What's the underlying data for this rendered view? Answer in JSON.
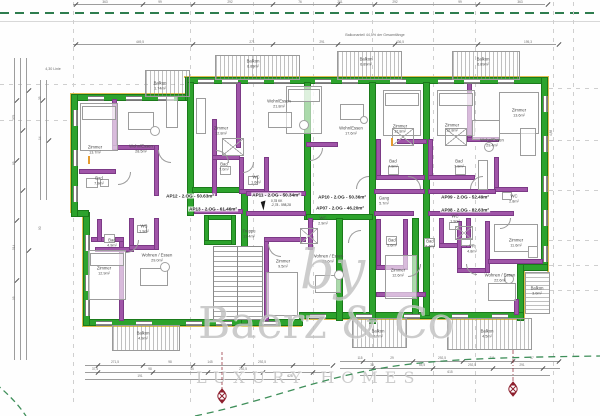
{
  "annotations": {
    "linie": "4,30 Linie",
    "balkon_note": "Balkonanteil 44,5% der Gesamtlänge",
    "right_dim": "4,88"
  },
  "watermark": {
    "by": "by",
    "brand": "Baerz & Co",
    "tagline": "LUXURY HOMES"
  },
  "cursor_tooltip": {
    "line1": "0,78 KK",
    "line2": "-2,78 - 598,28"
  },
  "apartments": [
    {
      "label": "AP12 - 2.OG - 50.63m²",
      "x": 190,
      "y": 196
    },
    {
      "label": "AP11 - 2.OG - 50.34m²",
      "x": 276,
      "y": 195
    },
    {
      "label": "AP10 - 2.OG - 50.36m²",
      "x": 342,
      "y": 197
    },
    {
      "label": "AP09 - 2.OG - 52.49m²",
      "x": 465,
      "y": 197
    },
    {
      "label": "AP13 - 2.OG - 61.46m²",
      "x": 213,
      "y": 209
    },
    {
      "label": "AP07 - 2.OG - 46.20m²",
      "x": 340,
      "y": 208
    },
    {
      "label": "AP08 - 2.OG - 82.63m²",
      "x": 465,
      "y": 210
    }
  ],
  "rooms": [
    {
      "name": "Zimmer",
      "area": "13.7m²",
      "x": 95,
      "y": 150
    },
    {
      "name": "Wohn/Essen",
      "area": "28.5m²",
      "x": 141,
      "y": 149
    },
    {
      "name": "Bad",
      "area": "7.9m²",
      "x": 99,
      "y": 181
    },
    {
      "name": "Balkon",
      "area": "1.74m²",
      "x": 160,
      "y": 86
    },
    {
      "name": "Balkon",
      "area": "6.89m²",
      "x": 253,
      "y": 64
    },
    {
      "name": "Balkon",
      "area": "6.89m²",
      "x": 366,
      "y": 62
    },
    {
      "name": "Balkon",
      "area": "6.89m²",
      "x": 483,
      "y": 62
    },
    {
      "name": "Zimmer",
      "area": "12.8m²",
      "x": 221,
      "y": 131
    },
    {
      "name": "Wohn/Essen",
      "area": "21.8m²",
      "x": 279,
      "y": 104
    },
    {
      "name": "Bad",
      "area": "7.0m²",
      "x": 224,
      "y": 167
    },
    {
      "name": "WC",
      "area": "1.6m²",
      "x": 256,
      "y": 180
    },
    {
      "name": "Wohn/Essen",
      "area": "17.6m²",
      "x": 351,
      "y": 131
    },
    {
      "name": "Zimmer",
      "area": "12.8m²",
      "x": 400,
      "y": 129
    },
    {
      "name": "Zimmer",
      "area": "12.8m²",
      "x": 452,
      "y": 128
    },
    {
      "name": "Wohn/Essen",
      "area": "29.4m²",
      "x": 492,
      "y": 143
    },
    {
      "name": "Bad",
      "area": "7.9m²",
      "x": 393,
      "y": 164
    },
    {
      "name": "Bad",
      "area": "7.9m²",
      "x": 459,
      "y": 164
    },
    {
      "name": "Gang",
      "area": "5.7m²",
      "x": 384,
      "y": 201
    },
    {
      "name": "WC",
      "area": "2.8m²",
      "x": 514,
      "y": 199
    },
    {
      "name": "Treppe",
      "area": "13.4m²",
      "x": 249,
      "y": 234
    },
    {
      "name": "Zimmer",
      "area": "12.9m²",
      "x": 104,
      "y": 271
    },
    {
      "name": "Bad",
      "area": "4.9m²",
      "x": 112,
      "y": 243
    },
    {
      "name": "WC",
      "area": "1.9m²",
      "x": 144,
      "y": 229
    },
    {
      "name": "Wohnen / Essen",
      "area": "29.0m²",
      "x": 157,
      "y": 258
    },
    {
      "name": "Balkon",
      "area": "4.9m²",
      "x": 143,
      "y": 336
    },
    {
      "name": "Zimmer",
      "area": "9.5m²",
      "x": 283,
      "y": 264
    },
    {
      "name": "Wohnen / Essen",
      "area": "23.6m²",
      "x": 328,
      "y": 259
    },
    {
      "name": "WC",
      "area": "2.9m²",
      "x": 323,
      "y": 221
    },
    {
      "name": "Bad",
      "area": "5.6m²",
      "x": 392,
      "y": 243
    },
    {
      "name": "Zimmer",
      "area": "12.6m²",
      "x": 398,
      "y": 273
    },
    {
      "name": "WC",
      "area": "1.9m²",
      "x": 455,
      "y": 219
    },
    {
      "name": "Bad",
      "area": "7.4m²",
      "x": 430,
      "y": 244
    },
    {
      "name": "VR",
      "area": "4.8m²",
      "x": 472,
      "y": 249
    },
    {
      "name": "Zimmer",
      "area": "11.6m²",
      "x": 516,
      "y": 243
    },
    {
      "name": "Wohnen / Essen",
      "area": "22.6m²",
      "x": 500,
      "y": 278
    },
    {
      "name": "Balkon",
      "area": "4.9m²",
      "x": 378,
      "y": 334
    },
    {
      "name": "Balkon",
      "area": "4.5m²",
      "x": 487,
      "y": 334
    },
    {
      "name": "Balkon",
      "area": "3.0m²",
      "x": 537,
      "y": 291
    },
    {
      "name": "Zimmer",
      "area": "13.6m²",
      "x": 519,
      "y": 113
    }
  ],
  "dims": {
    "top": [
      {
        "v": "363",
        "x": 105
      },
      {
        "v": "99",
        "x": 160
      },
      {
        "v": "292",
        "x": 230
      },
      {
        "v": "76",
        "x": 300
      },
      {
        "v": "201",
        "x": 340
      },
      {
        "v": "292",
        "x": 395
      },
      {
        "v": "99",
        "x": 460
      },
      {
        "v": "363",
        "x": 520
      }
    ],
    "mid": [
      {
        "v": "449,5",
        "x": 140
      },
      {
        "v": "271",
        "x": 252
      },
      {
        "v": "291",
        "x": 322
      },
      {
        "v": "436,5",
        "x": 400
      },
      {
        "v": "195,3",
        "x": 528
      }
    ],
    "left": [
      {
        "v": "375",
        "y": 120
      },
      {
        "v": "85",
        "y": 165
      },
      {
        "v": "514",
        "y": 250
      },
      {
        "v": "95",
        "y": 300
      }
    ],
    "left2": [
      {
        "v": "35",
        "y": 100
      },
      {
        "v": "14",
        "y": 140
      },
      {
        "v": "90",
        "y": 230
      }
    ],
    "bottom": [
      {
        "v": "271,5",
        "x": 115,
        "y": 364
      },
      {
        "v": "98",
        "x": 170,
        "y": 364
      },
      {
        "v": "145",
        "x": 210,
        "y": 364
      },
      {
        "v": "292,5",
        "x": 262,
        "y": 364
      },
      {
        "v": "37,5",
        "x": 95,
        "y": 371
      },
      {
        "v": "98",
        "x": 150,
        "y": 371
      },
      {
        "v": "45",
        "x": 192,
        "y": 371
      },
      {
        "v": "292,5",
        "x": 243,
        "y": 371
      },
      {
        "v": "625",
        "x": 290,
        "y": 378
      },
      {
        "v": "191",
        "x": 140,
        "y": 378
      },
      {
        "v": "115",
        "x": 360,
        "y": 360
      },
      {
        "v": "29",
        "x": 392,
        "y": 360
      },
      {
        "v": "292,5",
        "x": 442,
        "y": 360
      },
      {
        "v": "211",
        "x": 492,
        "y": 360
      },
      {
        "v": "57",
        "x": 532,
        "y": 360
      },
      {
        "v": "38",
        "x": 372,
        "y": 367
      },
      {
        "v": "55,5",
        "x": 422,
        "y": 367
      },
      {
        "v": "292,5",
        "x": 472,
        "y": 367
      },
      {
        "v": "291",
        "x": 522,
        "y": 367
      },
      {
        "v": "615",
        "x": 450,
        "y": 374
      }
    ]
  }
}
